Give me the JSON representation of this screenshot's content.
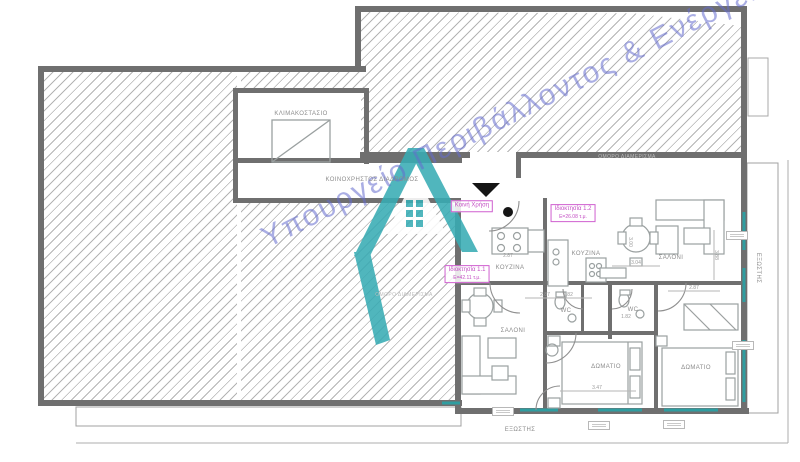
{
  "colors": {
    "wall": "#6f6f6f",
    "teal_window": "#2f9da0",
    "magenta": "#c44fc4",
    "watermark_blue": "#646ccd",
    "logo_teal": "#38acb4",
    "hatch_line": "#b4b4b4"
  },
  "watermark": {
    "text": "Υπουργείο Περιβάλλοντος & Ενέργειας"
  },
  "plan": {
    "labels": [
      {
        "t": "ΚΛΙΜΑΚΟΣΤΑΣΙΟ",
        "x": 301,
        "y": 114,
        "cls": "room",
        "n": "label-stairwell"
      },
      {
        "t": "ΚΟΙΝΟΧΡΗΣΤΟΣ ΔΙΑΔΡΟΜΟΣ",
        "x": 372,
        "y": 180,
        "cls": "room",
        "n": "label-common-corridor"
      },
      {
        "t": "ΟΜΟΡΟ ΔΙΑΜΕΡΙΣΜΑ",
        "x": 404,
        "y": 295,
        "cls": "faint",
        "n": "label-adjacent-apartment"
      },
      {
        "t": "ΟΜΟΡΟ ΔΙΑΜΕΡΙΣΜΑ",
        "x": 627,
        "y": 157,
        "cls": "faint",
        "n": "label-adjacent-apartment"
      },
      {
        "t": "ΚΟΥΖΙΝΑ",
        "x": 510,
        "y": 268,
        "cls": "room",
        "n": "label-kitchen-1"
      },
      {
        "t": "ΚΟΥΖΙΝΑ",
        "x": 586,
        "y": 254,
        "cls": "room",
        "n": "label-kitchen-2"
      },
      {
        "t": "ΣΑΛΟΝΙ",
        "x": 671,
        "y": 258,
        "cls": "room",
        "n": "label-living-2"
      },
      {
        "t": "ΣΑΛΟΝΙ",
        "x": 513,
        "y": 331,
        "cls": "room",
        "n": "label-living-1"
      },
      {
        "t": "WC",
        "x": 566,
        "y": 311,
        "cls": "room",
        "n": "label-wc-1"
      },
      {
        "t": "WC",
        "x": 633,
        "y": 310,
        "cls": "room",
        "n": "label-wc-2"
      },
      {
        "t": "ΔΩΜΑΤΙΟ",
        "x": 606,
        "y": 367,
        "cls": "room",
        "n": "label-bedroom-1"
      },
      {
        "t": "ΔΩΜΑΤΙΟ",
        "x": 696,
        "y": 368,
        "cls": "room",
        "n": "label-bedroom-2"
      },
      {
        "t": "ΕΞΩΣΤΗΣ",
        "x": 520,
        "y": 430,
        "cls": "room",
        "n": "label-balcony-south"
      },
      {
        "t": "ΕΞΩΣΤΗΣ",
        "x": 758,
        "y": 268,
        "cls": "room vert",
        "n": "label-balcony-east"
      },
      {
        "t": "2.87",
        "x": 508,
        "y": 256,
        "cls": "dim",
        "n": "dim-label"
      },
      {
        "t": "3.04",
        "x": 636,
        "y": 263,
        "cls": "dim",
        "n": "dim-label"
      },
      {
        "t": "2.87",
        "x": 694,
        "y": 288,
        "cls": "dim",
        "n": "dim-label"
      },
      {
        "t": "2.87",
        "x": 545,
        "y": 295,
        "cls": "dim",
        "n": "dim-label"
      },
      {
        "t": "1.82",
        "x": 568,
        "y": 295,
        "cls": "dim",
        "n": "dim-label"
      },
      {
        "t": "1.82",
        "x": 626,
        "y": 317,
        "cls": "dim",
        "n": "dim-label"
      },
      {
        "t": "3.47",
        "x": 597,
        "y": 388,
        "cls": "dim",
        "n": "dim-label"
      },
      {
        "t": "3.88",
        "x": 716,
        "y": 255,
        "cls": "dim vert",
        "n": "dim-label"
      },
      {
        "t": "3.00",
        "x": 630,
        "y": 242,
        "cls": "dim vert",
        "n": "dim-label"
      }
    ],
    "property_boxes": [
      {
        "title": "Ιδιοκτησία 1.2",
        "area": "Ε=26.08 τ.μ.",
        "x": 573,
        "y": 213,
        "n": "property-label-1-2"
      },
      {
        "title": "Ιδιοκτησία 1.1",
        "area": "Ε=42.11 τ.μ.",
        "x": 467,
        "y": 274,
        "n": "property-label-1-1"
      },
      {
        "title": "Κοινή Χρήση",
        "area": "",
        "x": 472,
        "y": 206,
        "n": "property-label-common"
      }
    ],
    "window_tags": [
      {
        "x": 492,
        "y": 407
      },
      {
        "x": 588,
        "y": 421
      },
      {
        "x": 663,
        "y": 420
      },
      {
        "x": 726,
        "y": 231
      },
      {
        "x": 732,
        "y": 341
      }
    ]
  }
}
